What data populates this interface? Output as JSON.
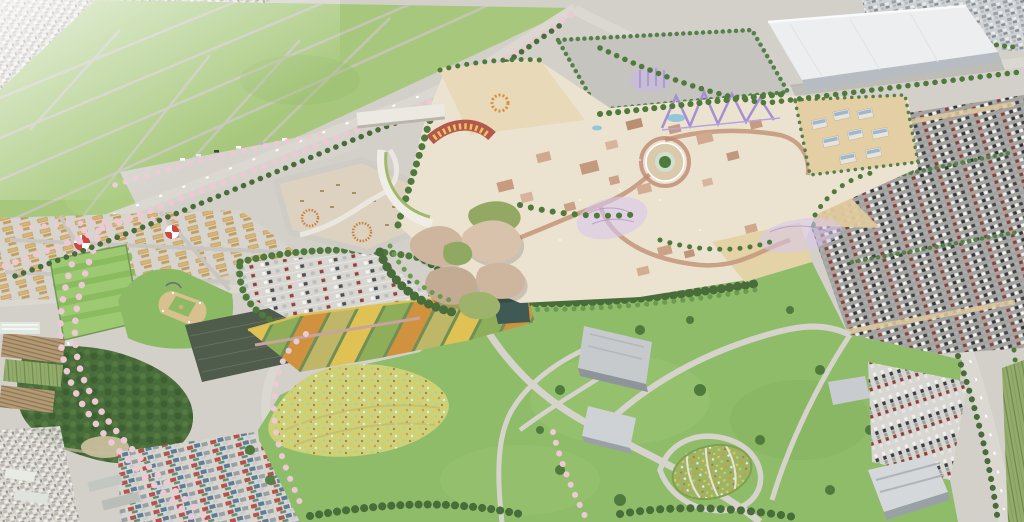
{
  "scene": {
    "type": "aerial-architectural-rendering",
    "description": "Bird's-eye master-plan rendering of an amusement park with petal-roofed entrance pavilions, purple roller coasters, a hedged service pad, a white logistics warehouse, mega parking lots full of cars, a festival market street with circus tents, sports fields and a baseball diamond, striped flower beds, a wildflower meadow, a great lawn with winding paths and an oval flower garden, bordered by farmland, woodland and residential districts with cherry-blossom lined avenues",
    "regions": [
      {
        "id": "residential-northwest",
        "label": "Dense residential district (north-west)"
      },
      {
        "id": "farm-fields-north",
        "label": "Open green farm fields"
      },
      {
        "id": "festival-market",
        "label": "Festival market street with stalls and circus tents"
      },
      {
        "id": "event-plaza",
        "label": "Leaf-shaped outdoor event plaza"
      },
      {
        "id": "entrance-complex",
        "label": "Park entrance with petal-roofed pavilions"
      },
      {
        "id": "theme-park",
        "label": "Amusement park core with themed buildings"
      },
      {
        "id": "coaster",
        "label": "Purple roller-coaster structures"
      },
      {
        "id": "central-plaza",
        "label": "Circular central plaza with landmark tree"
      },
      {
        "id": "service-pad",
        "label": "Hedged service pad"
      },
      {
        "id": "warehouse",
        "label": "Large white logistics warehouse"
      },
      {
        "id": "residential-northeast",
        "label": "Industrial blocks (north-east)"
      },
      {
        "id": "solar-village",
        "label": "Buildings with rooftop solar panels"
      },
      {
        "id": "mega-parking",
        "label": "Main visitor parking lot"
      },
      {
        "id": "center-parking",
        "label": "Central parking lot"
      },
      {
        "id": "striped-field",
        "label": "Striped sports field"
      },
      {
        "id": "baseball-field",
        "label": "Baseball diamond"
      },
      {
        "id": "dark-field",
        "label": "Netted practice field"
      },
      {
        "id": "flower-strips",
        "label": "Striped flower beds"
      },
      {
        "id": "flower-meadow",
        "label": "Wildflower meadow"
      },
      {
        "id": "great-lawn",
        "label": "Great lawn with winding paths"
      },
      {
        "id": "museum",
        "label": "Gray visitor-center buildings"
      },
      {
        "id": "oval-garden",
        "label": "Oval patterned flower garden"
      },
      {
        "id": "south-parking",
        "label": "South-east parking lot and hall"
      },
      {
        "id": "forest",
        "label": "Preserved woodland"
      },
      {
        "id": "farm-plots",
        "label": "Small farm plots and greenhouses"
      },
      {
        "id": "neighborhood-south",
        "label": "Existing houses along the south edge"
      },
      {
        "id": "cherry-avenues",
        "label": "Cherry-blossom lined avenues"
      }
    ]
  },
  "palette": {
    "roadBase": "#d3d0ca",
    "roadLight": "#dbd8d2",
    "urban": "#dddad4",
    "urbanNE": "#cfd2d4",
    "fieldGreen": "#a7c87c",
    "fieldPath": "#c8c5be",
    "parkGreen": "#8fbc68",
    "treeDark": "#4e7a3c",
    "treeLight": "#6b9a50",
    "forest": "#486c3a",
    "cherry": "#eccad4",
    "asphalt": "#a5a39e",
    "asphaltLight": "#d8d6d0",
    "sandPlaza": "#ddd2c0",
    "themeCream": "#ece2d0",
    "sandKids": "#e8d9b8",
    "tan": "#e3cfa3",
    "roseBldg": "#cba285",
    "purple": "#a68fd2",
    "purpleWash": "#d8c8ec",
    "solarBlue": "#9db7cf",
    "warehouseTop": "#eceef0",
    "warehouseSide": "#b7bcc2",
    "grayBldg": "#c6cacd",
    "infield": "#d9c18f",
    "outfield": "#8cb964",
    "darkField": "#4f5b4b",
    "meadowBase": "#ccd17c",
    "ovalBase": "#9db464",
    "tentRed": "#cc4840",
    "water": "#93c6d8",
    "pathGray": "#d6d3cc",
    "hedge": "#55804a"
  }
}
